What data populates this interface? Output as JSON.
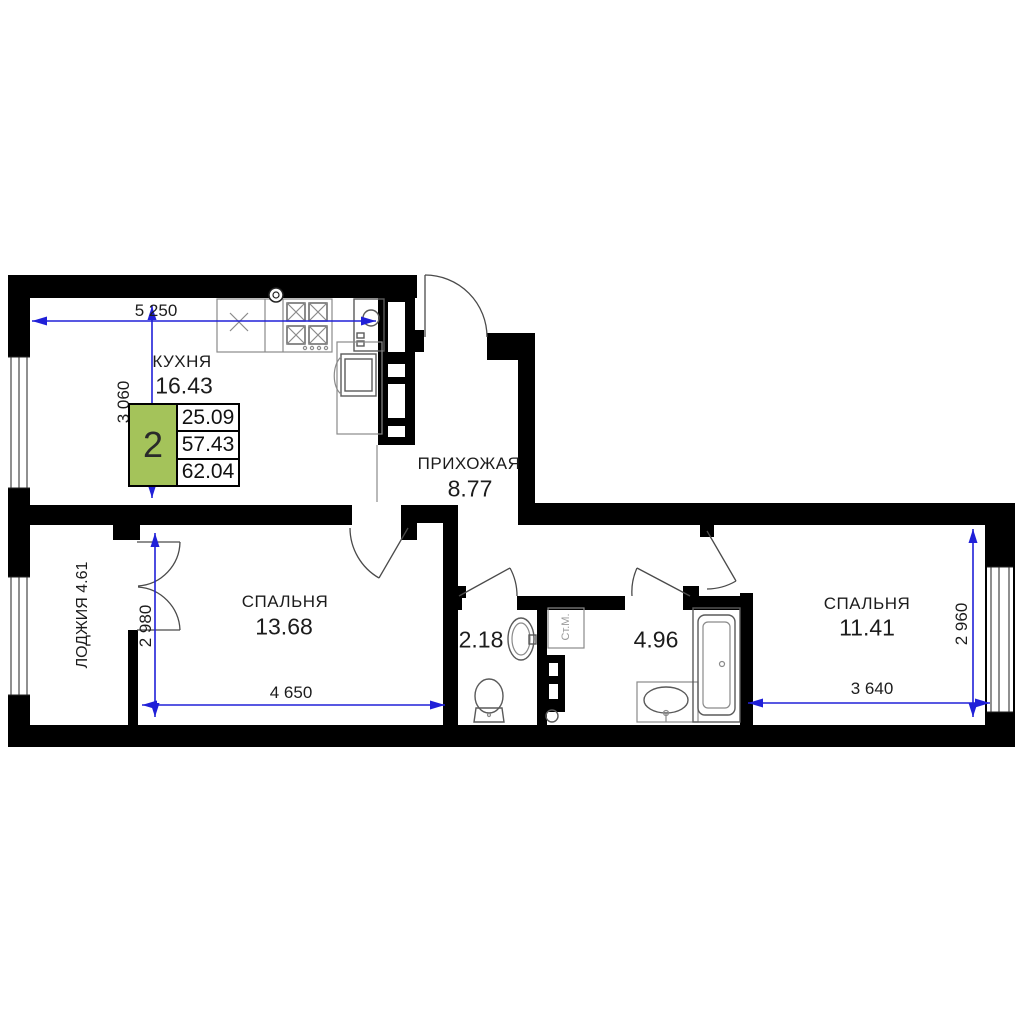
{
  "legend": {
    "rooms_count": "2",
    "values": [
      "25.09",
      "57.43",
      "62.04"
    ]
  },
  "rooms": {
    "kitchen": {
      "label": "КУХНЯ",
      "area": "16.43"
    },
    "hallway": {
      "label": "ПРИХОЖАЯ",
      "area": "8.77"
    },
    "bedroom1": {
      "label": "СПАЛЬНЯ",
      "area": "13.68"
    },
    "bedroom2": {
      "label": "СПАЛЬНЯ",
      "area": "11.41"
    },
    "loggia": {
      "label": "ЛОДЖИЯ 4.61"
    },
    "wc": {
      "area": "2.18"
    },
    "bathroom": {
      "area": "4.96"
    },
    "washer": {
      "label": "Ст.М."
    }
  },
  "dimensions": {
    "kitchen_width": "5 250",
    "kitchen_depth": "3 060",
    "bedroom1_depth": "2 980",
    "bedroom1_width": "4 650",
    "bedroom2_width": "3 640",
    "bedroom2_depth": "2 960"
  },
  "colors": {
    "wall": "#000000",
    "dimension_blue": "#2020d8",
    "legend_green": "#a4c35a"
  },
  "icons": [
    "vent-icon",
    "kitchen-sink-icon",
    "stove-icon",
    "fridge-icon",
    "kitchen-cabinet-icon",
    "wc-sink-icon",
    "toilet-icon",
    "washing-machine-spot-icon",
    "bath-sink-icon",
    "bathtub-icon",
    "window-icon",
    "door-swing-icon"
  ]
}
